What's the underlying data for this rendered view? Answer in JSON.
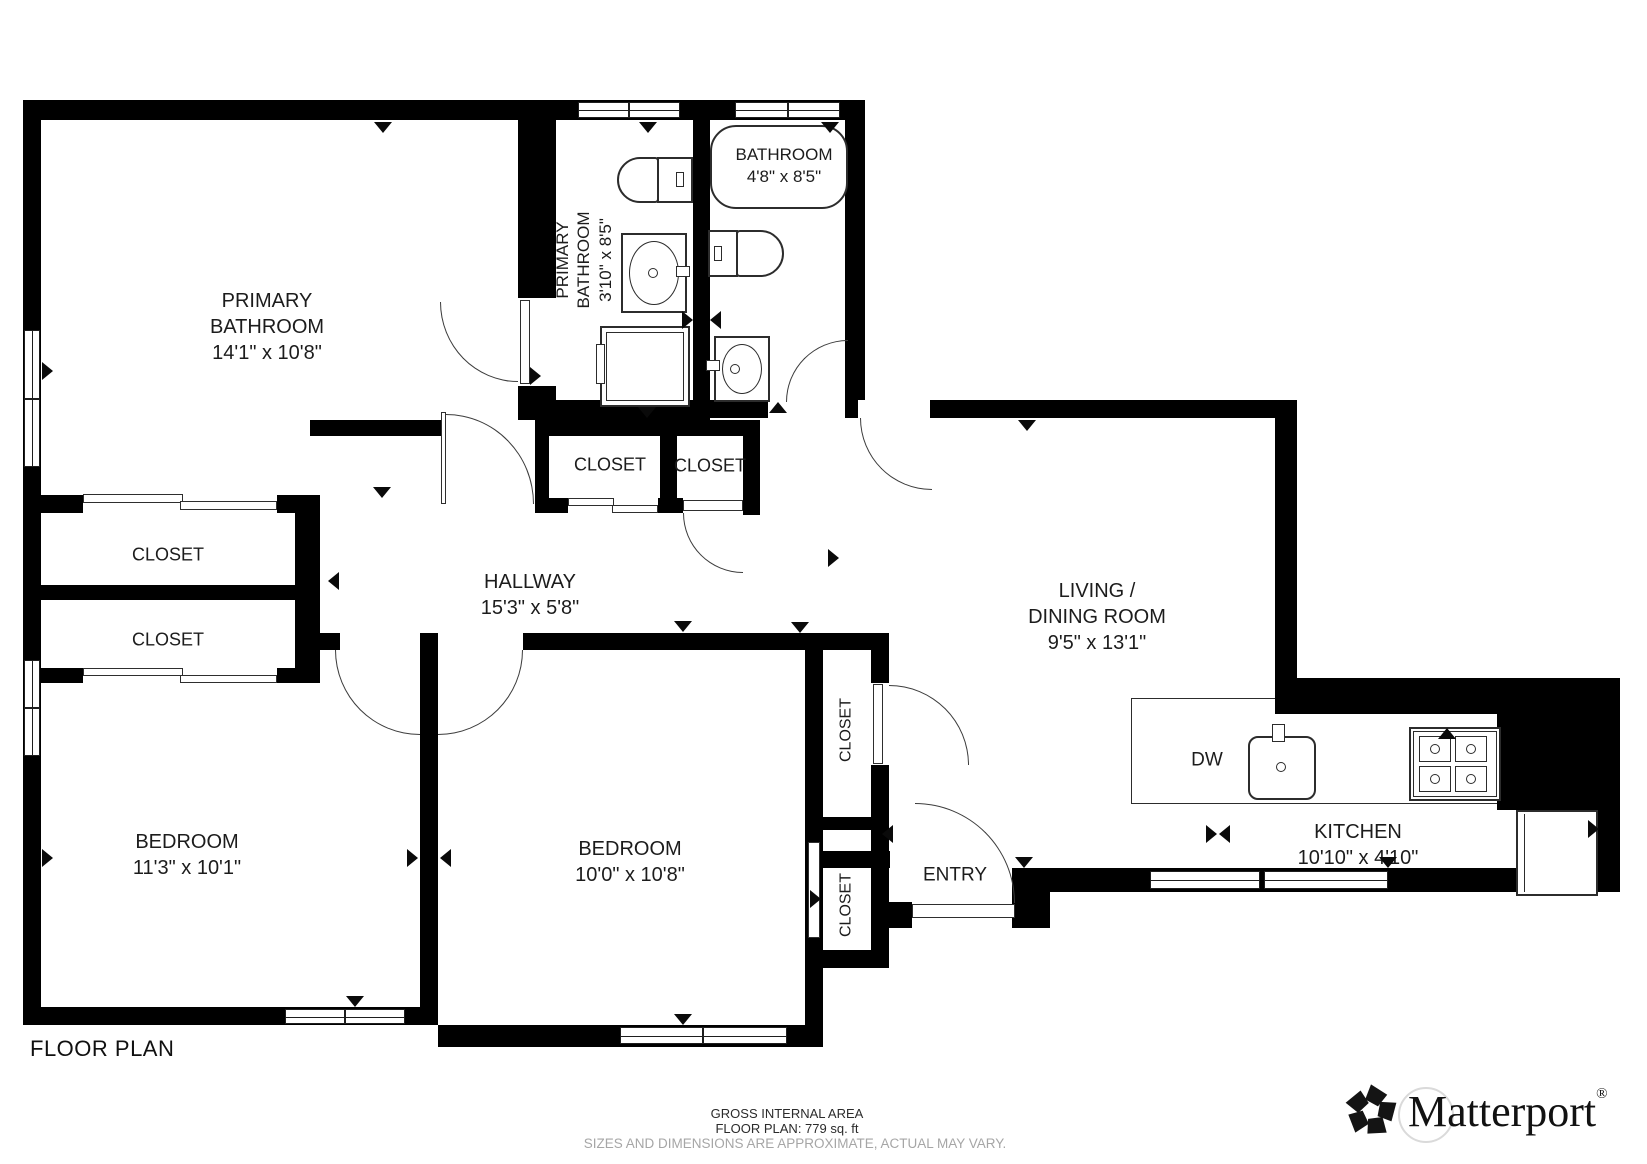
{
  "title": "FLOOR PLAN",
  "rooms": {
    "primary_bedroom": {
      "line1": "PRIMARY",
      "line2": "BATHROOM",
      "dims": "14'1\" x 10'8\""
    },
    "primary_bathroom": {
      "line1": "PRIMARY",
      "line2": "BATHROOM",
      "dims": "3'10\" x 8'5\""
    },
    "bathroom": {
      "name": "BATHROOM",
      "dims": "4'8\" x 8'5\""
    },
    "closet_hall_1": {
      "name": "CLOSET"
    },
    "closet_hall_2": {
      "name": "CLOSET"
    },
    "closet_left_1": {
      "name": "CLOSET"
    },
    "closet_left_2": {
      "name": "CLOSET"
    },
    "hallway": {
      "name": "HALLWAY",
      "dims": "15'3\" x 5'8\""
    },
    "living_dining": {
      "line1": "LIVING /",
      "line2": "DINING ROOM",
      "dims": "9'5\" x 13'1\""
    },
    "bedroom_left": {
      "name": "BEDROOM",
      "dims": "11'3\" x 10'1\""
    },
    "bedroom_mid": {
      "name": "BEDROOM",
      "dims": "10'0\" x 10'8\""
    },
    "closet_vert_1": {
      "name": "CLOSET"
    },
    "closet_vert_2": {
      "name": "CLOSET"
    },
    "entry": {
      "name": "ENTRY"
    },
    "kitchen": {
      "name": "KITCHEN",
      "dims": "10'10\" x 4'10\""
    },
    "dishwasher": {
      "label": "DW"
    }
  },
  "footer": {
    "area_label": "GROSS INTERNAL AREA",
    "area_value": "FLOOR PLAN: 779 sq. ft",
    "disclaimer": "SIZES AND DIMENSIONS ARE APPROXIMATE, ACTUAL MAY VARY.",
    "brand": "Matterport",
    "brand_mark": "®"
  },
  "colors": {
    "walls": "#000000",
    "background": "#ffffff",
    "label_text": "#1c1c1c",
    "muted_text": "#a6a6a6",
    "fixture_line": "#2c2c2c"
  }
}
